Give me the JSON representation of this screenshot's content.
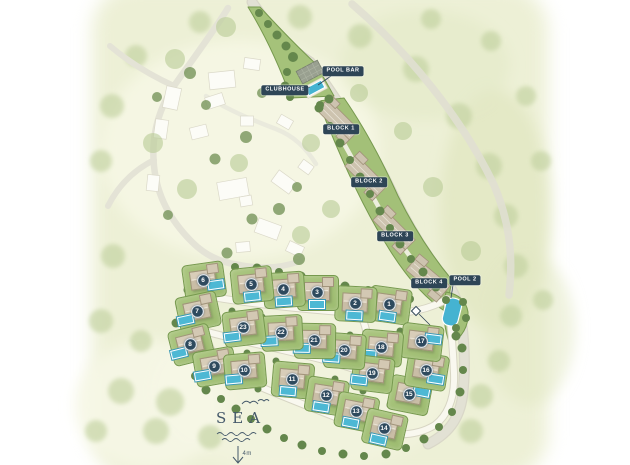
{
  "map": {
    "palette": {
      "map_bg": "#edf0d6",
      "road_gray": "#e2e1d4",
      "road_white": "#f9f8ef",
      "parcel_green": "#a5c27a",
      "hedge_green": "#76994e",
      "tree_dark": "#64874c",
      "tree_sage": "#c2d2a0",
      "building_tan": "#d3c8b3",
      "existing_white": "#fcfcf7",
      "pool_cyan": "#4db8d4",
      "chip_navy": "#2e4556",
      "sea_text": "#45596a"
    },
    "labels": [
      {
        "id": "pool-bar",
        "text": "POOL BAR",
        "x": 343,
        "y": 71
      },
      {
        "id": "clubhouse",
        "text": "CLUBHOUSE",
        "x": 285,
        "y": 90
      },
      {
        "id": "block-1",
        "text": "BLOCK 1",
        "x": 341,
        "y": 129
      },
      {
        "id": "block-2",
        "text": "BLOCK 2",
        "x": 369,
        "y": 182
      },
      {
        "id": "block-3",
        "text": "BLOCK 3",
        "x": 395,
        "y": 236
      },
      {
        "id": "block-4",
        "text": "BLOCK 4",
        "x": 429,
        "y": 283
      },
      {
        "id": "pool-2",
        "text": "POOL 2",
        "x": 465,
        "y": 280
      }
    ],
    "villas": [
      {
        "n": "1",
        "x": 389,
        "y": 304,
        "rot": 8,
        "pool": [
          0,
          12
        ]
      },
      {
        "n": "2",
        "x": 355,
        "y": 303,
        "rot": 3,
        "pool": [
          0,
          12
        ]
      },
      {
        "n": "3",
        "x": 317,
        "y": 292,
        "rot": 0,
        "pool": [
          0,
          12
        ]
      },
      {
        "n": "4",
        "x": 283,
        "y": 289,
        "rot": -4,
        "pool": [
          0,
          12
        ]
      },
      {
        "n": "5",
        "x": 251,
        "y": 284,
        "rot": -6,
        "pool": [
          0,
          12
        ]
      },
      {
        "n": "6",
        "x": 203,
        "y": 280,
        "rot": -8,
        "pool": [
          12,
          6
        ]
      },
      {
        "n": "7",
        "x": 197,
        "y": 311,
        "rot": -12,
        "pool": [
          -13,
          6
        ]
      },
      {
        "n": "8",
        "x": 190,
        "y": 344,
        "rot": -14,
        "pool": [
          -13,
          6
        ]
      },
      {
        "n": "9",
        "x": 214,
        "y": 366,
        "rot": -10,
        "pool": [
          -13,
          7
        ]
      },
      {
        "n": "10",
        "x": 244,
        "y": 370,
        "rot": -5,
        "pool": [
          -11,
          8
        ]
      },
      {
        "n": "11",
        "x": 292,
        "y": 379,
        "rot": 5,
        "pool": [
          -3,
          12
        ]
      },
      {
        "n": "12",
        "x": 326,
        "y": 395,
        "rot": 9,
        "pool": [
          -3,
          12
        ]
      },
      {
        "n": "13",
        "x": 356,
        "y": 411,
        "rot": 11,
        "pool": [
          -3,
          12
        ]
      },
      {
        "n": "14",
        "x": 384,
        "y": 428,
        "rot": 13,
        "pool": [
          -3,
          12
        ]
      },
      {
        "n": "15",
        "x": 409,
        "y": 394,
        "rot": 11,
        "pool": [
          12,
          -5
        ]
      },
      {
        "n": "16",
        "x": 426,
        "y": 370,
        "rot": 9,
        "pool": [
          11,
          7
        ]
      },
      {
        "n": "17",
        "x": 421,
        "y": 341,
        "rot": 7,
        "pool": [
          12,
          -4
        ]
      },
      {
        "n": "18",
        "x": 381,
        "y": 347,
        "rot": 5,
        "pool": [
          -12,
          8
        ]
      },
      {
        "n": "19",
        "x": 372,
        "y": 373,
        "rot": 7,
        "pool": [
          -12,
          8
        ]
      },
      {
        "n": "20",
        "x": 344,
        "y": 350,
        "rot": 4,
        "pool": [
          -12,
          8
        ]
      },
      {
        "n": "21",
        "x": 314,
        "y": 340,
        "rot": 1,
        "pool": [
          -12,
          8
        ]
      },
      {
        "n": "22",
        "x": 281,
        "y": 332,
        "rot": -3,
        "pool": [
          -12,
          8
        ]
      },
      {
        "n": "23",
        "x": 243,
        "y": 327,
        "rot": -7,
        "pool": [
          -12,
          8
        ]
      }
    ],
    "sea": {
      "label": "SEA",
      "distance": "4m"
    }
  }
}
